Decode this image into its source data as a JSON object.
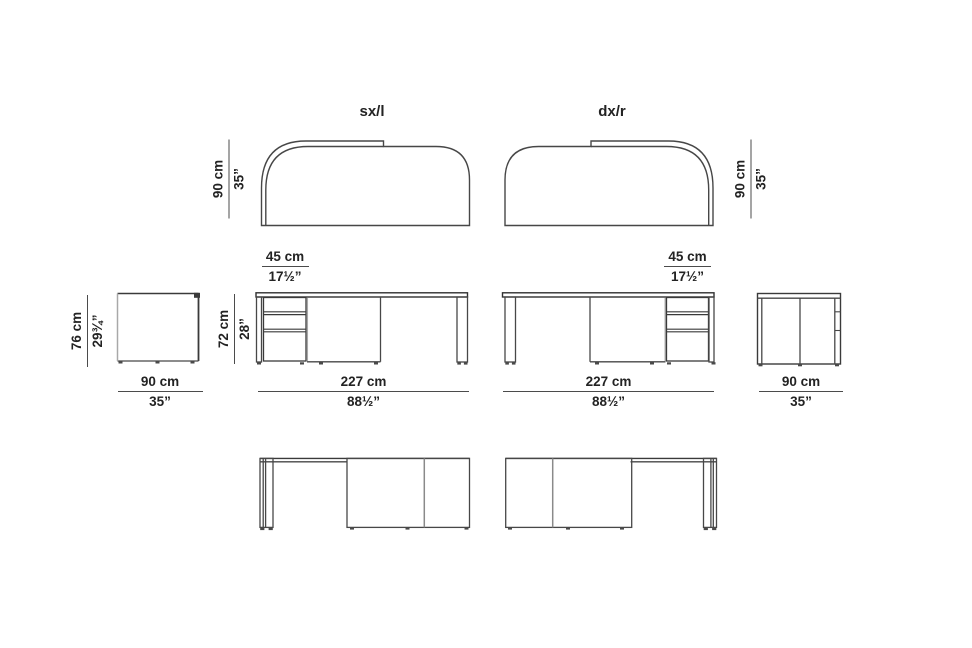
{
  "labels": {
    "left_version": "sx/l",
    "right_version": "dx/r"
  },
  "dimensions": {
    "top_left_depth": {
      "cm": "90 cm",
      "in": "35”"
    },
    "top_right_depth": {
      "cm": "90 cm",
      "in": "35”"
    },
    "side_left_height": {
      "cm": "76 cm",
      "in": "29¾”"
    },
    "desk_height": {
      "cm": "72 cm",
      "in": "28”"
    },
    "pedestal_left": {
      "cm": "45 cm",
      "in": "17½”"
    },
    "pedestal_right": {
      "cm": "45 cm",
      "in": "17½”"
    },
    "side_left_width": {
      "cm": "90 cm",
      "in": "35”"
    },
    "desk_width_left": {
      "cm": "227 cm",
      "in": "88½”"
    },
    "desk_width_right": {
      "cm": "227 cm",
      "in": "88½”"
    },
    "side_right_width": {
      "cm": "90 cm",
      "in": "35”"
    }
  },
  "colors": {
    "line": "#474747",
    "line_dark": "#303030",
    "line_light": "#a8a8a8",
    "text": "#232323",
    "background": "#ffffff"
  }
}
